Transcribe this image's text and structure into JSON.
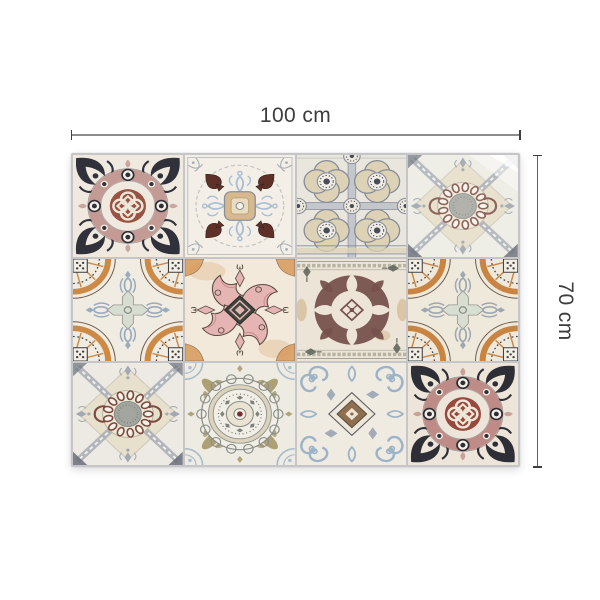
{
  "page": {
    "background": "#ffffff"
  },
  "dimensions": {
    "width": {
      "label": "100 cm"
    },
    "height": {
      "label": "70 cm"
    },
    "line_color": "#8c8c8c",
    "tick_color": "#3f3f3f",
    "label_color": "#3d3d3d"
  },
  "photo": {
    "description": "patchwork mat of twelve decorative azulejo-style tiles, 4 columns by 3 rows",
    "grout_color": "#c6c6c8",
    "grid": {
      "rows": 3,
      "cols": 4
    },
    "tiles": [
      {
        "pattern": "rose-medallion",
        "name": "rose knot medallion",
        "colors": {
          "bg": "#efe9df",
          "wreath": "#c49a94",
          "knot": "#9a5243",
          "dark": "#30313a",
          "accent": "#c9a79f"
        }
      },
      {
        "pattern": "spade-square",
        "name": "maroon spade tile",
        "colors": {
          "bg": "#f3efe6",
          "motif": "#5e3028",
          "square": "#d8b98d",
          "inner": "#e9dcc0",
          "blue": "#a8bcd6",
          "line": "#9aa0a8"
        }
      },
      {
        "pattern": "quatrefoil-grid",
        "name": "quatrefoil lattice",
        "colors": {
          "bg": "#e9e6de",
          "line": "#868c98",
          "fill": "#ddd2b6",
          "dark": "#474d59"
        }
      },
      {
        "pattern": "x-ribbon",
        "name": "ribbon cross medallion curled corner",
        "washed": true,
        "colors": {
          "bg": "#eceae2",
          "diamond": "#e3dbc2",
          "ribbon": "#9aa0ac",
          "bead": "#7c4a3e",
          "disc": "#a3a69e",
          "dark": "#5a5f6a"
        }
      },
      {
        "pattern": "orange-fans",
        "name": "orange fan corners",
        "colors": {
          "bg": "#f1ece1",
          "orange": "#cd8a46",
          "blue": "#9aabbe",
          "cross": "#d5dccf",
          "dark": "#3f3f45"
        }
      },
      {
        "pattern": "pink-damask",
        "name": "pink acanthus cross",
        "colors": {
          "bg": "#f2e9da",
          "pink": "#e5b5b3",
          "dark": "#3f443c",
          "orange": "#d89a5c",
          "outline": "#5a4a42"
        }
      },
      {
        "pattern": "plum-damask",
        "name": "plum damask wreath",
        "colors": {
          "bg": "#ece4d6",
          "plum": "#77524c",
          "tan": "#c8a878",
          "border": "#8a8a80",
          "sprig": "#5a5f55"
        }
      },
      {
        "pattern": "orange-fans",
        "name": "orange fan corners variant",
        "colors": {
          "bg": "#efe9dc",
          "orange": "#c98441",
          "blue": "#9fa8b0",
          "cross": "#d7ddd2",
          "dark": "#44444c"
        }
      },
      {
        "pattern": "x-ribbon",
        "name": "ribbon cross medallion",
        "colors": {
          "bg": "#edeae3",
          "diamond": "#e6dfc9",
          "ribbon": "#a3a8b2",
          "bead": "#7c4a3e",
          "disc": "#a3a69e",
          "dark": "#6a6f7a"
        }
      },
      {
        "pattern": "scallop-mandala",
        "name": "scalloped mandala",
        "colors": {
          "bg": "#eeebe2",
          "ring": "#8a8f8a",
          "khaki": "#a59868",
          "blue": "#a9bccd",
          "center": "#7a2c28",
          "tan": "#cfc2a0"
        }
      },
      {
        "pattern": "blue-scrolls",
        "name": "blue scroll medallion",
        "colors": {
          "bg": "#f0ebe0",
          "blue": "#9db3c9",
          "bronze": "#8a6848",
          "dark": "#55555c"
        }
      },
      {
        "pattern": "rose-medallion",
        "name": "rose knot medallion variant",
        "colors": {
          "bg": "#eee5da",
          "wreath": "#bf8b86",
          "knot": "#96493c",
          "dark": "#2e2f36",
          "accent": "#c7a29b"
        }
      }
    ]
  }
}
